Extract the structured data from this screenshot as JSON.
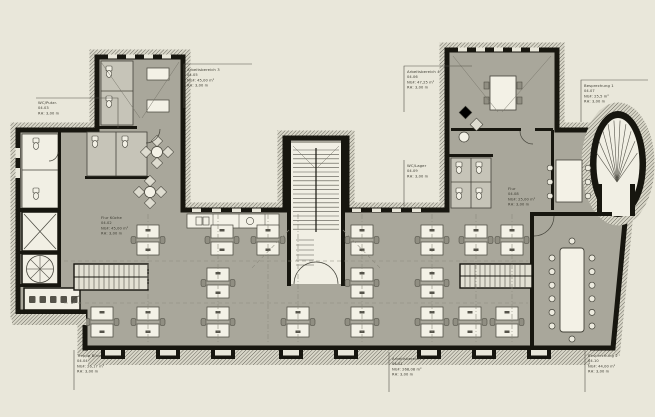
{
  "drawing": {
    "type": "architectural-floor-plan",
    "floor": "Dachgeschoss",
    "colors": {
      "background": "#e9e7da",
      "floor_gray": "#a9a79b",
      "cell_gray": "#c6c4b8",
      "white_room": "#f1efe4",
      "wall_black": "#17160f",
      "hatch_line": "#504e45",
      "furniture": "#f3f1e6",
      "text": "#3b3a30"
    },
    "labels": [
      {
        "name": "WC/Putzr.",
        "code": "04.03",
        "area": "",
        "height": "RH:  3,00 m"
      },
      {
        "name": "Arbeitsbereich 3",
        "code": "04.05",
        "area": "NGF:  45,00 m²",
        "height": "RH:  3,00 m"
      },
      {
        "name": "Arbeitsbereich 4",
        "code": "04.06",
        "area": "NGF:  47,25 m²",
        "height": "RH:  3,00 m"
      },
      {
        "name": "Besprechung 1",
        "code": "04.07",
        "area": "NGF:  25,5 m²",
        "height": "RH:  3,00 m"
      },
      {
        "name": "Flur Küche",
        "code": "04.02",
        "area": "NGF:  45,00 m²",
        "height": "RH:  3,00 m"
      },
      {
        "name": "WC/Lager",
        "code": "04.09",
        "area": "",
        "height": "RH:  3,00 m"
      },
      {
        "name": "Flur",
        "code": "04.08",
        "area": "NGF:  25,00 m²",
        "height": "RH:  3,00 m"
      },
      {
        "name": "Treppe Büro",
        "code": "04.04",
        "area": "NGF:  26,17 m²",
        "height": "RH:  3,00 m"
      },
      {
        "name": "Arbeitsbereich 1",
        "code": "04.01",
        "area": "NGF:  268,08 m²",
        "height": "RH:  3,00 m"
      },
      {
        "name": "Besprechung 2",
        "code": "04.10",
        "area": "NGF:  44,00 m²",
        "height": "RH:  3,00 m"
      }
    ]
  }
}
